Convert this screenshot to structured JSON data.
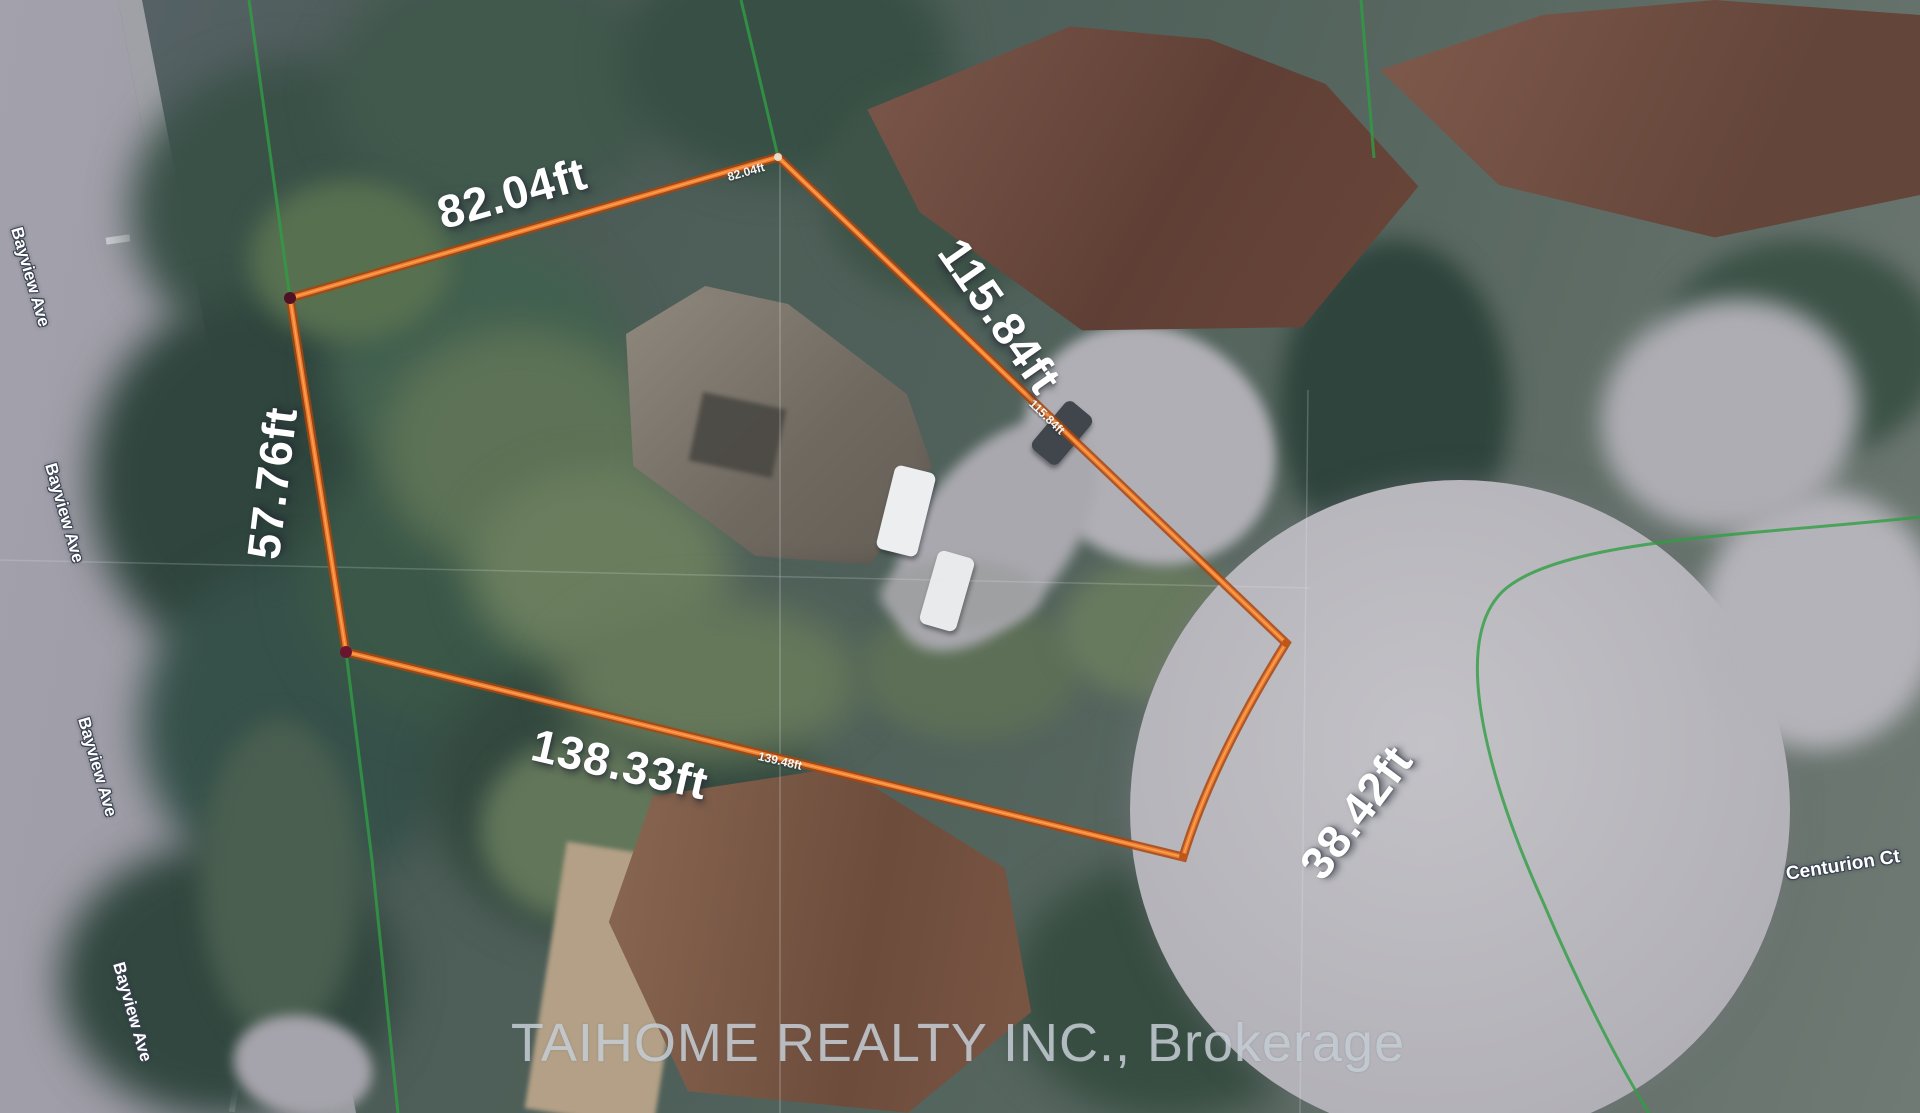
{
  "map": {
    "watermark": "TAIHOME REALTY INC., Brokerage",
    "dimensions": {
      "top": "82.04ft",
      "right": "115.84ft",
      "left": "57.76ft",
      "bottom": "138.33ft",
      "culdesac": "38.42ft"
    },
    "measure_ticks": {
      "top": "82.04ft",
      "right": "115.84ft",
      "bottom": "139.48ft"
    },
    "streets": {
      "bayview": "Bayview Ave",
      "centurion": "Centurion Ct"
    },
    "colors": {
      "lot_outline": "#F07E2E",
      "lot_outline_casing": "#A8450F",
      "survey_line": "#2F9E44",
      "dimension_text": "#FFFFFF"
    }
  }
}
